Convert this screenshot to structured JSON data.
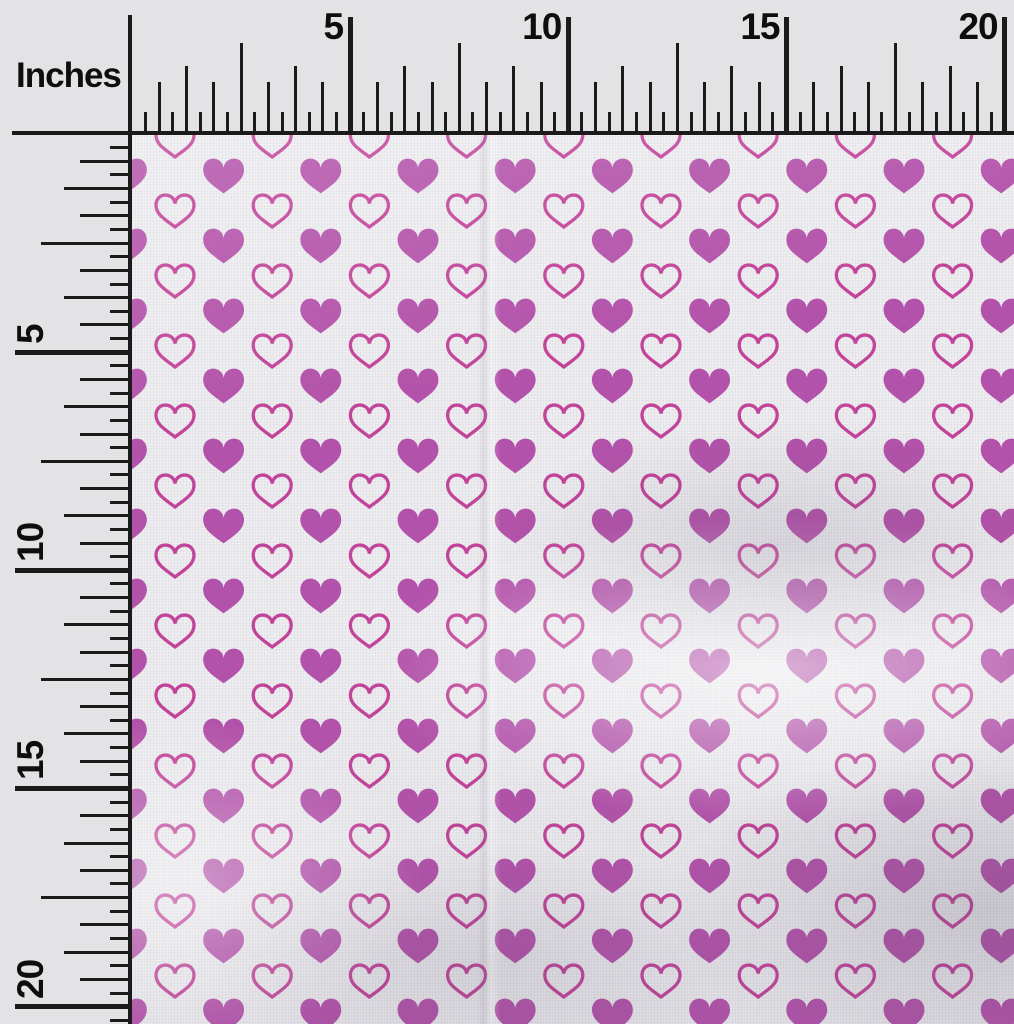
{
  "ruler": {
    "unit_label": "Inches",
    "top_numbers": [
      "5",
      "10",
      "15",
      "20"
    ],
    "left_numbers": [
      "5",
      "10",
      "15",
      "20"
    ],
    "tick_color": "#1b1b1b",
    "text_color": "#0e0e0e",
    "background_color": "#e3e2e5",
    "origin_x": 132,
    "origin_y": 134,
    "pixels_per_label_interval": 218.15,
    "minor_ticks_per_interval": 16,
    "tick_heights": {
      "minor": 22,
      "medium": 52,
      "tall": 68,
      "xtall": 91,
      "major": 117
    }
  },
  "fabric": {
    "description": "white fabric swatch with alternating solid and outline hearts",
    "base_color": "#eae9ed",
    "filled_heart_color": "#b352aa",
    "outline_heart_color": "#c2439a",
    "pattern_grid": {
      "column_spacing": 97.2,
      "row_spacing": 70,
      "outline_hearts": {
        "x0": 175,
        "y0": 141,
        "width": 40,
        "height": 34,
        "stroke": 3.3
      },
      "filled_hearts": {
        "x0": 126.4,
        "y0": 176,
        "width": 43,
        "height": 37
      }
    },
    "area": {
      "left": 132,
      "top": 134,
      "width": 882,
      "height": 890
    }
  }
}
